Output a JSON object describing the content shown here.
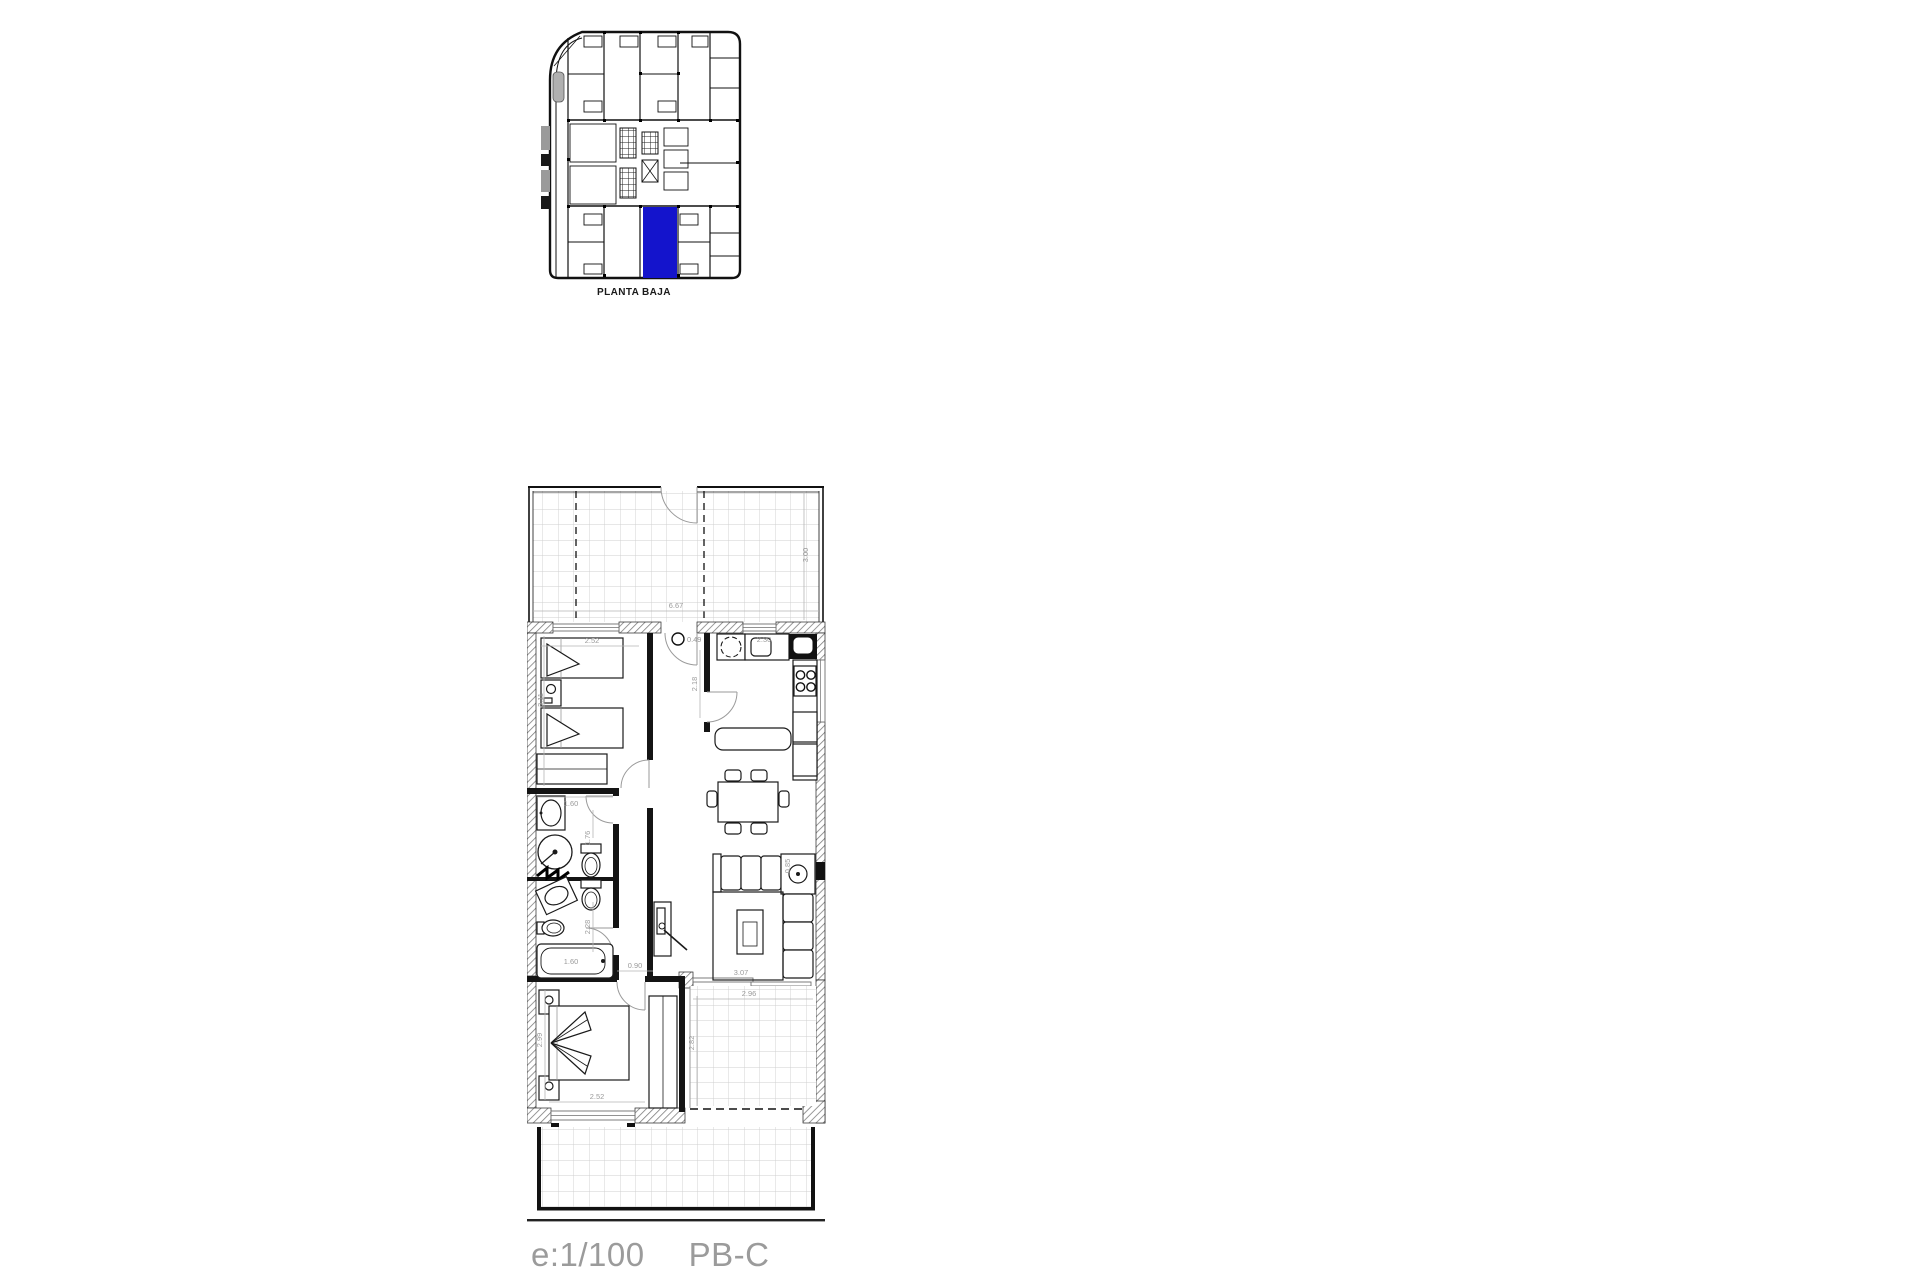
{
  "overview": {
    "label": "PLANTA BAJA"
  },
  "caption": {
    "scale": "e:1/100",
    "unit": "PB-C"
  },
  "colors": {
    "highlight": "#1414CC",
    "dimension_gray": "#9a9a9a",
    "caption_gray": "#9b9b9b"
  },
  "dims": {
    "terrace_width": "6.67",
    "terrace_depth": "3.00",
    "bedroom1_width": "2.52",
    "bedroom1_depth": "3.11",
    "entry_width": "0.49",
    "kitchen_width": "2.30",
    "hall_depth": "2.18",
    "bath1_width": "1.60",
    "bath1_depth": "1.76",
    "bath2_depth": "2.28",
    "bathtub_width": "1.60",
    "hall_width": "0.90",
    "living_width": "3.07",
    "sofa_side": "0.85",
    "patio_width": "2.96",
    "patio_depth": "2.82",
    "bedroom2_width": "2.52",
    "bedroom2_depth": "2.99"
  }
}
